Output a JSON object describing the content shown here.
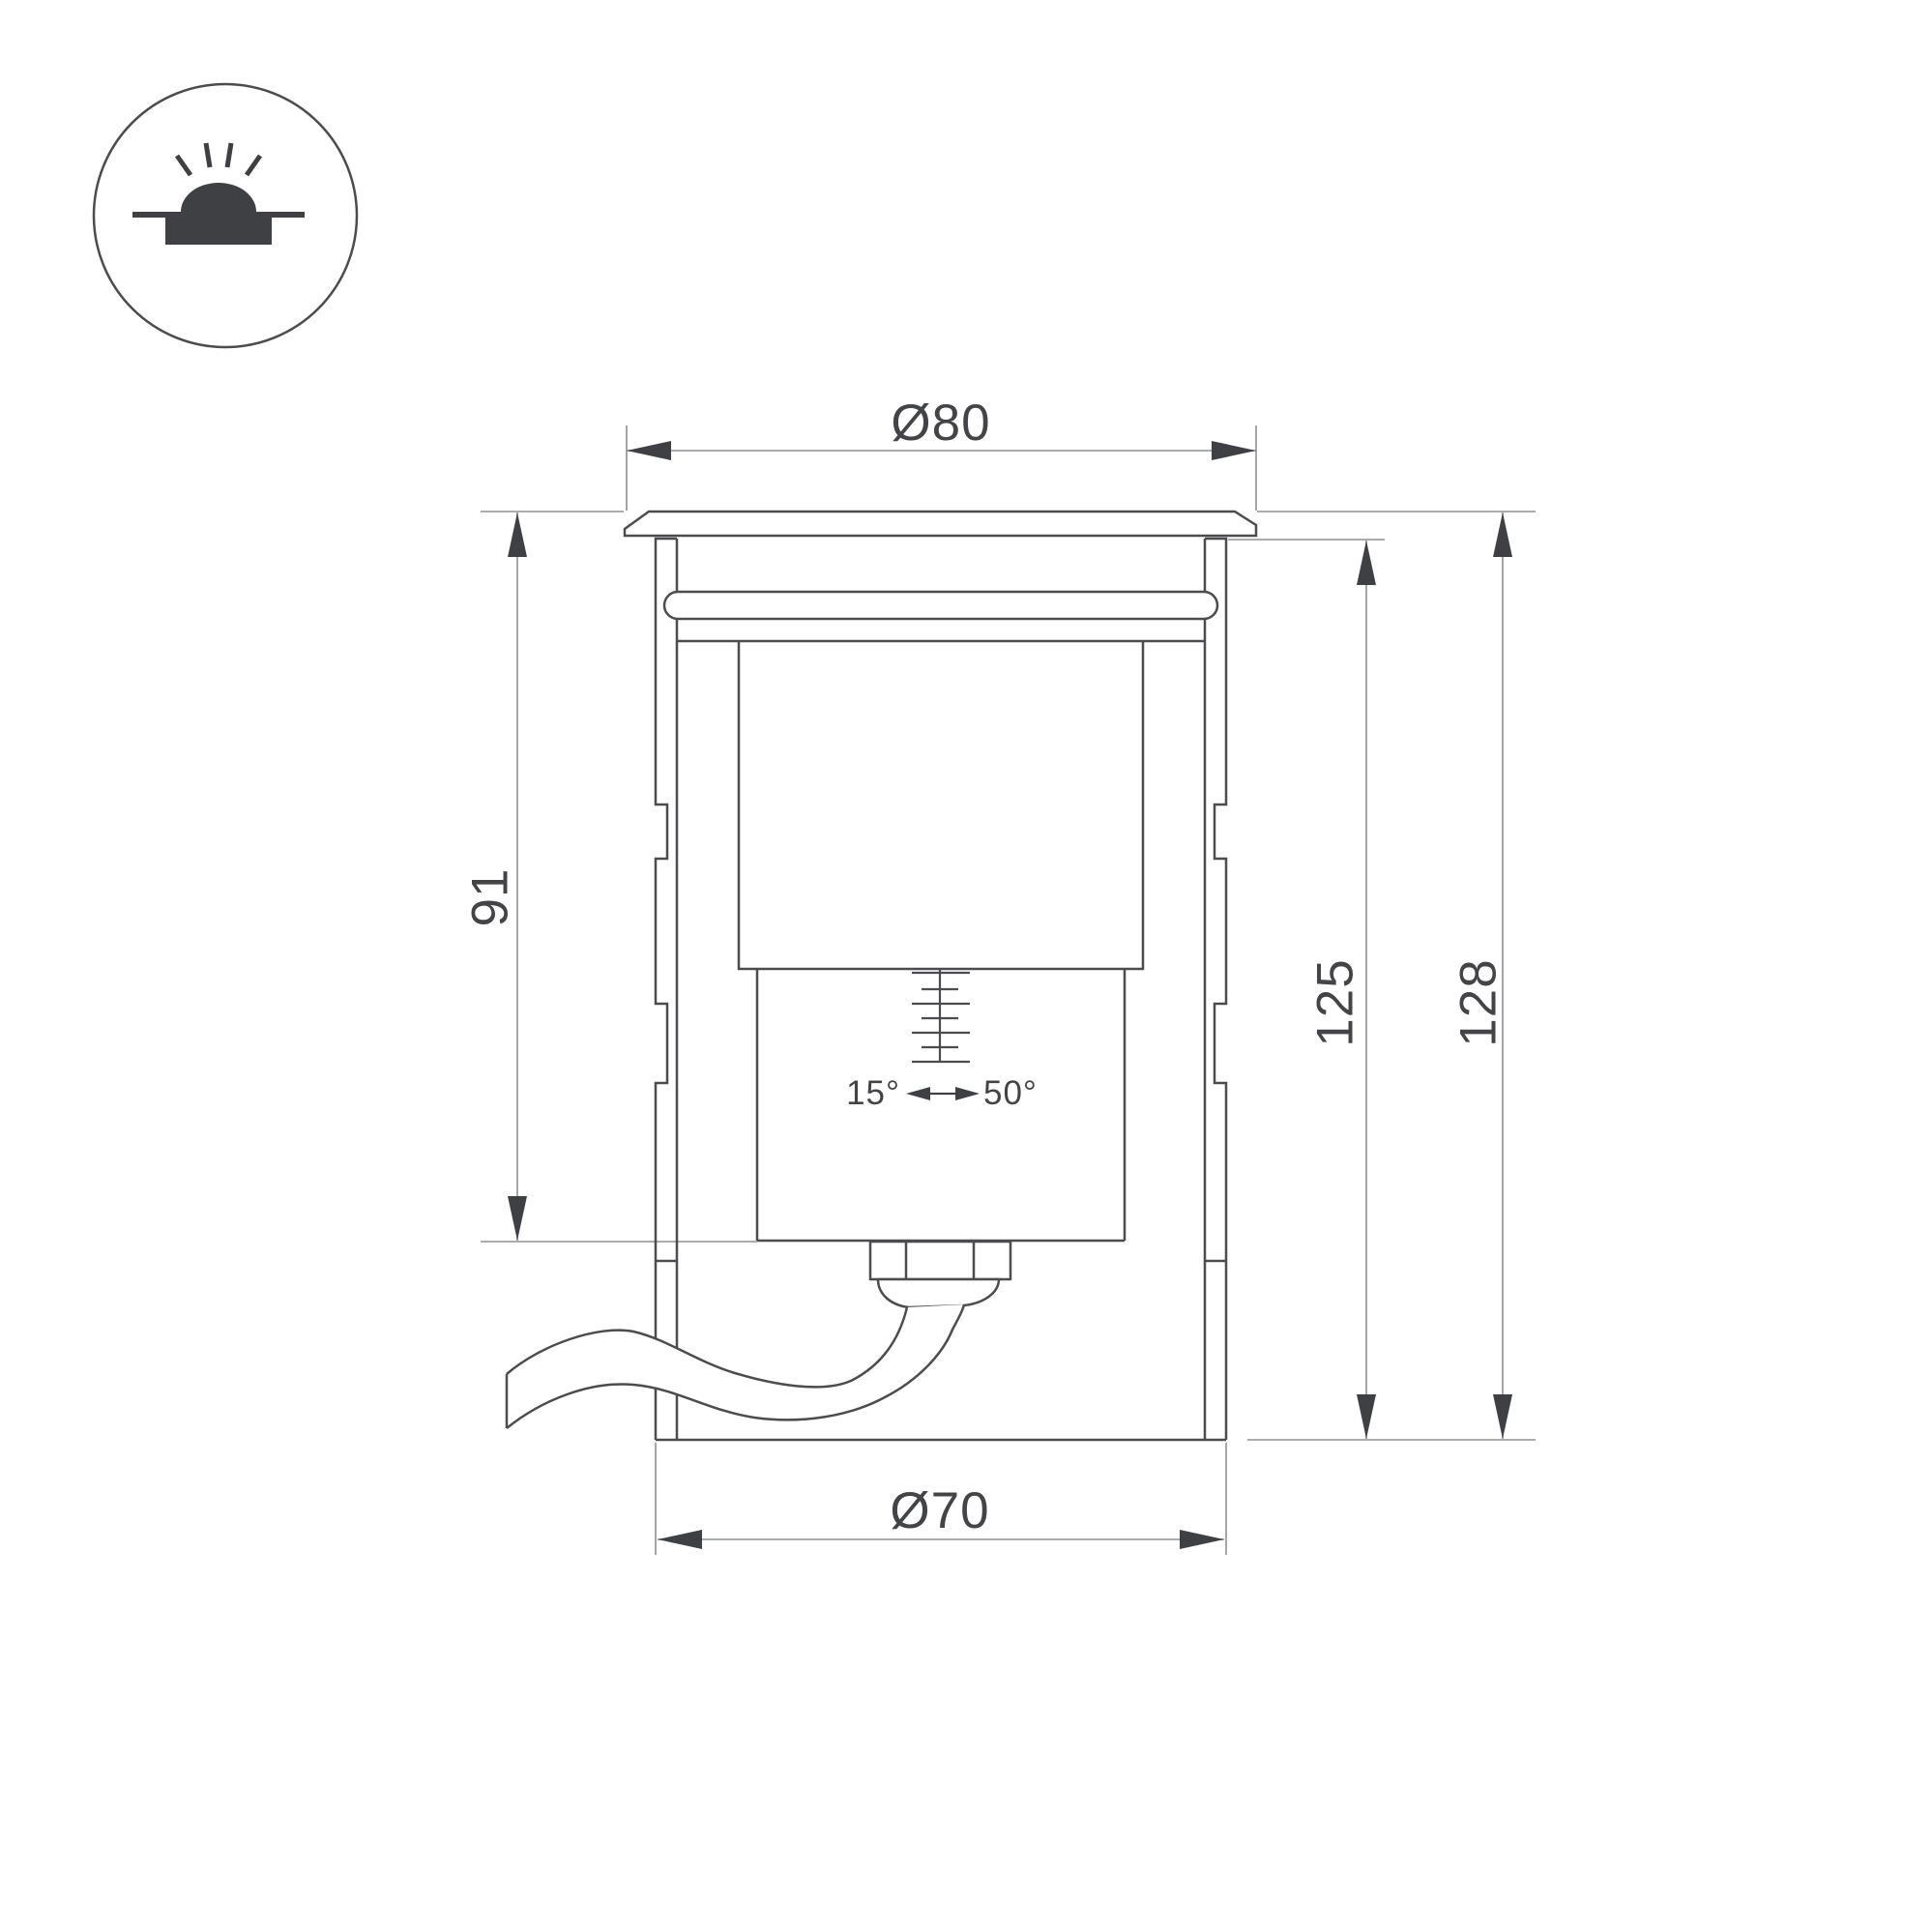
{
  "page": {
    "background": "#ffffff"
  },
  "colors": {
    "background": "#ffffff",
    "outline": "#4b4c50",
    "thin_line": "#8f9093",
    "dark": "#3e4044",
    "text": "#434447"
  },
  "icon": {
    "name": "recessed-ground-luminaire-symbol"
  },
  "dimensions": {
    "top_diameter": "Ø80",
    "bottom_diameter": "Ø70",
    "recess_depth": "91",
    "body_height": "125",
    "total_height": "128",
    "tilt_min": "15°",
    "tilt_max": "50°"
  }
}
